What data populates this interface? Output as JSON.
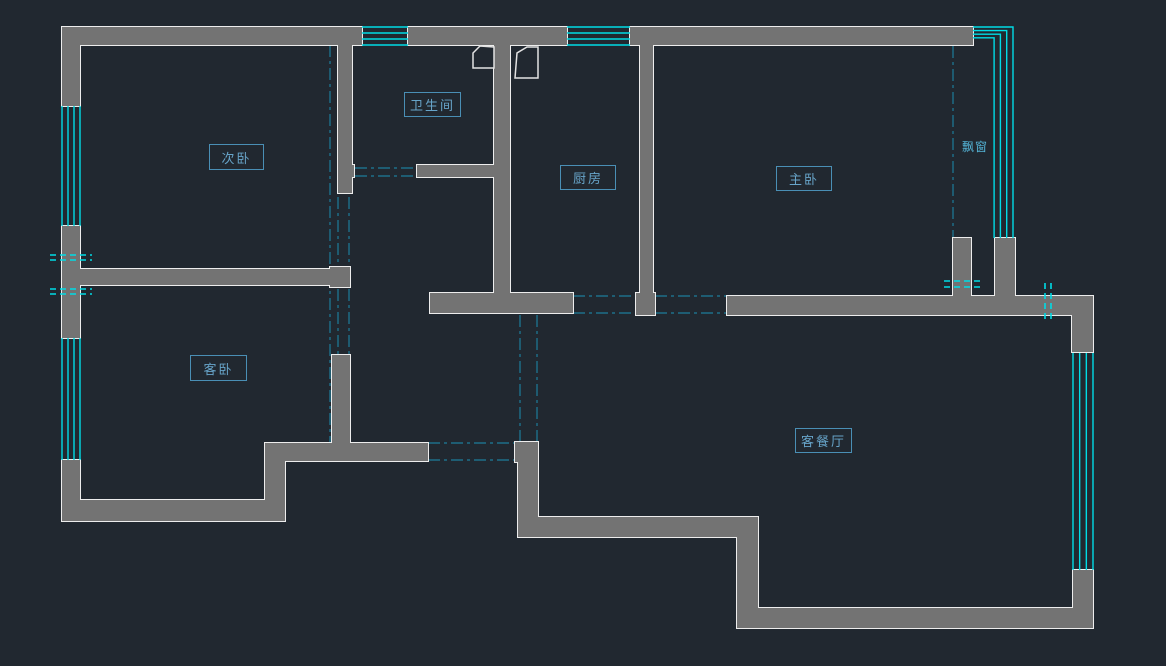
{
  "app": {
    "type": "cad-floor-plan",
    "description": "Dark-background CAD residential floor plan with gray walls, cyan windows and dash-dot door openings"
  },
  "canvas": {
    "width": 1166,
    "height": 666,
    "bg": "#212830"
  },
  "colors": {
    "wall_fill": "#737373",
    "wall_outline": "#ededed",
    "window": "#00dce6",
    "axis": "#1d7d9b",
    "label_text": "#67a4c9",
    "label_border": "#4a8fb5",
    "door": "#e3e3e3"
  },
  "labels": [
    {
      "text": "次卧",
      "meaning": "secondary-bedroom",
      "x": 209,
      "y": 144,
      "w": 55,
      "h": 26,
      "boxed": true
    },
    {
      "text": "卫生间",
      "meaning": "bathroom",
      "x": 404,
      "y": 92,
      "w": 57,
      "h": 25,
      "boxed": true
    },
    {
      "text": "厨房",
      "meaning": "kitchen",
      "x": 560,
      "y": 165,
      "w": 56,
      "h": 25,
      "boxed": true
    },
    {
      "text": "主卧",
      "meaning": "master-bedroom",
      "x": 776,
      "y": 166,
      "w": 56,
      "h": 25,
      "boxed": true
    },
    {
      "text": "客卧",
      "meaning": "guest-bedroom",
      "x": 190,
      "y": 355,
      "w": 57,
      "h": 26,
      "boxed": true
    },
    {
      "text": "客餐厅",
      "meaning": "living-dining-room",
      "x": 795,
      "y": 428,
      "w": 57,
      "h": 25,
      "boxed": true
    },
    {
      "text": "飘窗",
      "meaning": "bay-window",
      "x": 957,
      "y": 136,
      "w": 36,
      "h": 20,
      "boxed": false
    }
  ],
  "geometry": {
    "walls": [
      [
        62,
        27,
        18,
        79
      ],
      [
        63,
        27,
        299,
        18
      ],
      [
        408,
        27,
        159,
        18
      ],
      [
        630,
        27,
        343,
        18
      ],
      [
        62,
        226,
        18,
        112
      ],
      [
        62,
        460,
        18,
        61
      ],
      [
        62,
        500,
        223,
        21
      ],
      [
        265,
        443,
        20,
        78
      ],
      [
        265,
        443,
        163,
        18
      ],
      [
        332,
        355,
        18,
        88
      ],
      [
        79,
        269,
        258,
        16
      ],
      [
        330,
        267,
        20,
        20
      ],
      [
        338,
        45,
        14,
        148
      ],
      [
        338,
        165,
        16,
        12
      ],
      [
        417,
        165,
        78,
        12
      ],
      [
        494,
        45,
        16,
        268
      ],
      [
        430,
        293,
        143,
        20
      ],
      [
        640,
        45,
        13,
        250
      ],
      [
        636,
        293,
        19,
        22
      ],
      [
        727,
        296,
        366,
        19
      ],
      [
        1072,
        296,
        21,
        56
      ],
      [
        953,
        238,
        18,
        60
      ],
      [
        995,
        238,
        20,
        58
      ],
      [
        515,
        442,
        23,
        20
      ],
      [
        518,
        462,
        20,
        75
      ],
      [
        518,
        517,
        240,
        20
      ],
      [
        737,
        537,
        21,
        91
      ],
      [
        757,
        608,
        336,
        20
      ],
      [
        1073,
        570,
        20,
        38
      ]
    ],
    "windows": [
      {
        "x": 362,
        "y": 27,
        "w": 46,
        "h": 18,
        "dir": "h"
      },
      {
        "x": 567,
        "y": 27,
        "w": 63,
        "h": 18,
        "dir": "h"
      },
      {
        "x": 62,
        "y": 106,
        "w": 18,
        "h": 120,
        "dir": "v"
      },
      {
        "x": 62,
        "y": 338,
        "w": 18,
        "h": 122,
        "dir": "v"
      },
      {
        "x": 1073,
        "y": 353,
        "w": 20,
        "h": 217,
        "dir": "v"
      }
    ],
    "bay_window": {
      "wall_x": 973,
      "top_ys": [
        27,
        30.6,
        34.2,
        37.8
      ],
      "corner_xs": [
        1013,
        1006.7,
        1000.4,
        994.1
      ],
      "bottom_y": 238
    },
    "openings": [
      [
        355,
        168,
        417,
        168
      ],
      [
        355,
        176,
        417,
        176
      ],
      [
        573,
        296,
        636,
        296
      ],
      [
        573,
        313,
        636,
        313
      ],
      [
        655,
        296,
        727,
        296
      ],
      [
        655,
        313,
        727,
        313
      ],
      [
        428,
        443,
        515,
        443
      ],
      [
        428,
        460,
        515,
        460
      ]
    ],
    "axis_lines": [
      [
        330,
        45,
        330,
        443
      ],
      [
        338,
        197,
        338,
        355
      ],
      [
        349,
        197,
        349,
        355
      ],
      [
        520,
        315,
        520,
        442
      ],
      [
        537,
        315,
        537,
        442
      ],
      [
        953,
        46,
        953,
        238
      ]
    ],
    "tick_lines": [
      [
        50,
        255,
        92,
        255
      ],
      [
        50,
        260,
        92,
        260
      ],
      [
        50,
        289,
        92,
        289
      ],
      [
        50,
        294,
        92,
        294
      ],
      [
        944,
        281,
        984,
        281
      ],
      [
        944,
        287,
        984,
        287
      ],
      [
        1045,
        283,
        1045,
        322
      ],
      [
        1051,
        283,
        1051,
        322
      ]
    ],
    "doors": [
      [
        [
          473,
          68
        ],
        [
          473,
          53
        ],
        [
          480,
          46
        ],
        [
          494,
          47
        ],
        [
          494,
          68
        ]
      ],
      [
        [
          515,
          78
        ],
        [
          517,
          53
        ],
        [
          527,
          47
        ],
        [
          538,
          47
        ],
        [
          538,
          78
        ]
      ]
    ]
  }
}
